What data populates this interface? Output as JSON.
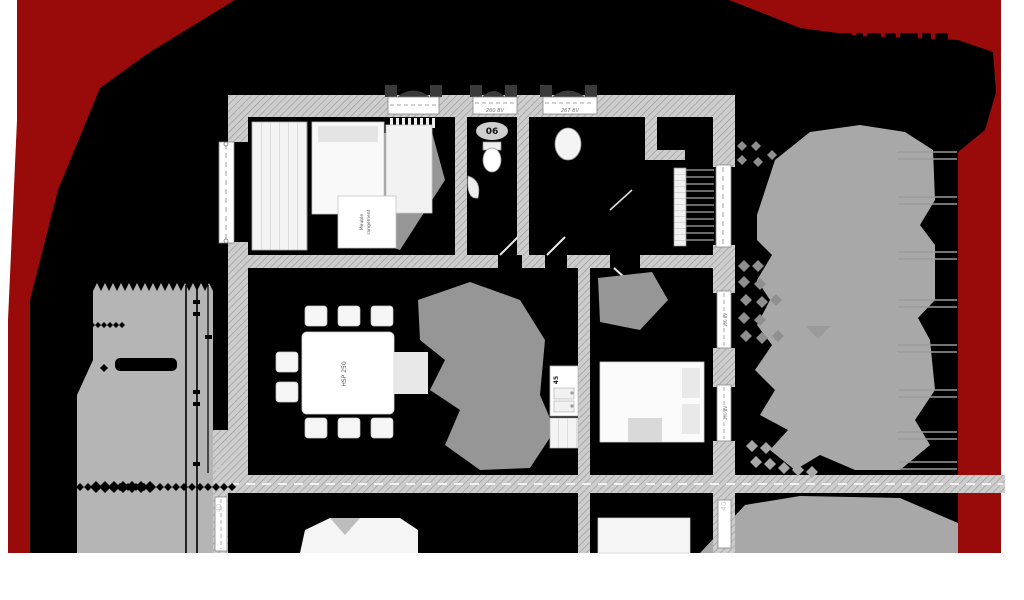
{
  "plan": {
    "labels": {
      "room_number": "06",
      "ceiling_height": "HSP 250",
      "furniture_note_line1": "Meuble",
      "furniture_note_line2": "rangement",
      "sink_width": "45",
      "window_head_1": "260 BV",
      "window_head_2": "267 BV",
      "side_window_1": "160 BV",
      "side_window_2": "160 BV",
      "wall_thickness": "40"
    },
    "colors": {
      "page": "#ffffff",
      "sheet_black": "#000000",
      "site_red": "#990b0b",
      "wall_fill": "#cdcdcd",
      "wall_hatch": "#9d9d9d",
      "terrace_gray": "#b5b5b5",
      "tree_gray": "#a8a8a8",
      "furniture_white": "#f7f7f7",
      "shadow_gray": "#969696"
    }
  }
}
